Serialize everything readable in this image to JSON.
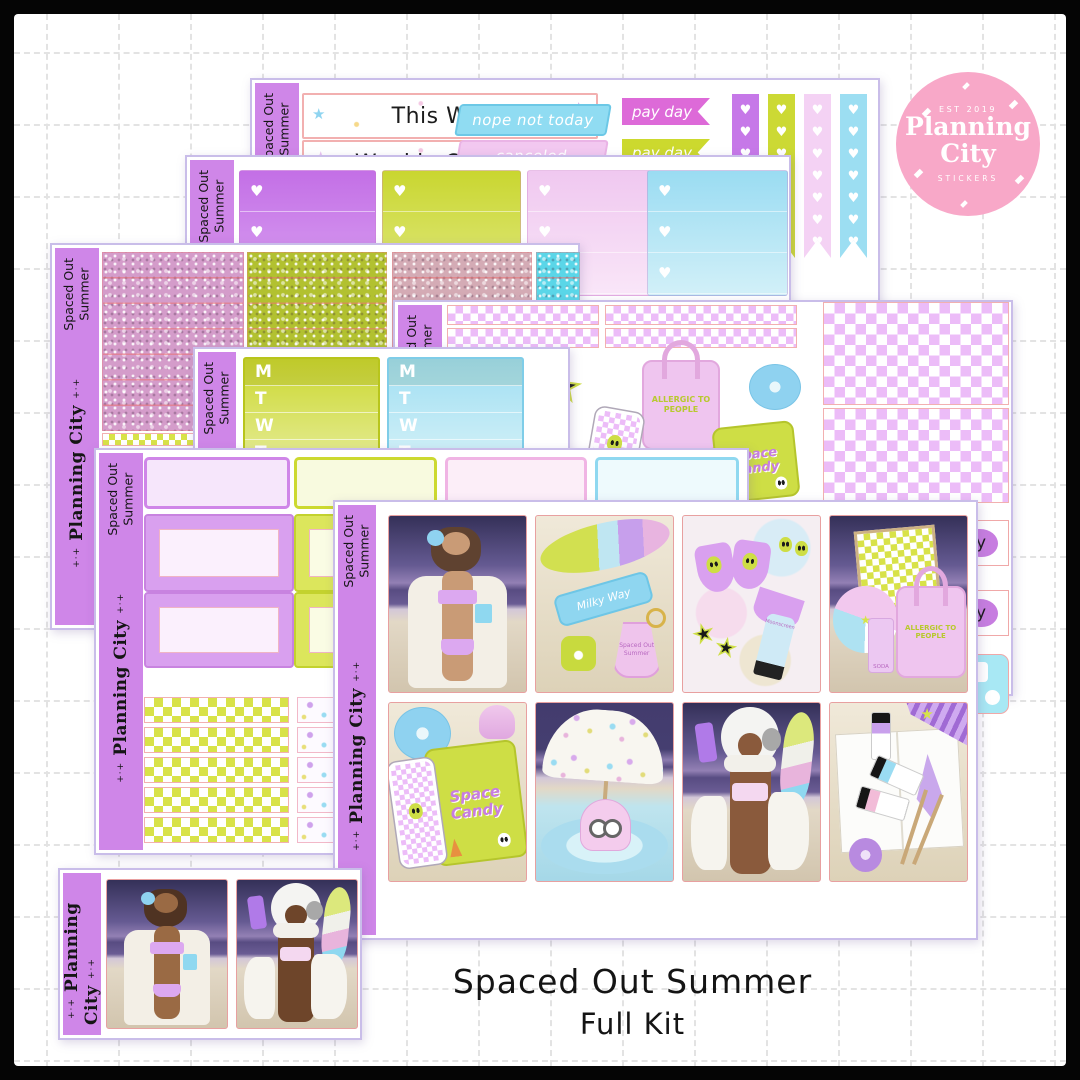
{
  "glyphs": {
    "heart": "♥",
    "star": "★"
  },
  "logo": {
    "est": "EST 2019",
    "name1": "Planning",
    "name2": "City",
    "subtitle": "STICKERS"
  },
  "title": {
    "line1": "Spaced Out Summer",
    "line2": "Full Kit"
  },
  "sidebar": {
    "kit1": "Spaced Out",
    "kit2": "Summer",
    "brand": "Planning City",
    "sparkle": "+·+"
  },
  "sheet_weekly": {
    "header1": "This Week",
    "header2": "Weekly Cleaning",
    "flag_blue": "nope not today",
    "flag_pink": "canceled",
    "tag_purple": "pay day",
    "tag_green": "pay day"
  },
  "date_cover": {
    "d0": "M",
    "d1": "T",
    "d2": "W",
    "d3": "T"
  },
  "stickers": {
    "tote": "Allergic to People",
    "candy1": "Space",
    "candy2": "Candy",
    "frag": "y"
  },
  "photo_text": {
    "milky": "Milky Way",
    "sunscreen": "Moonscreen",
    "soda": "SODA",
    "keychain": "Spaced Out Summer",
    "tote": "Allergic to People",
    "candy1": "Space",
    "candy2": "Candy"
  }
}
